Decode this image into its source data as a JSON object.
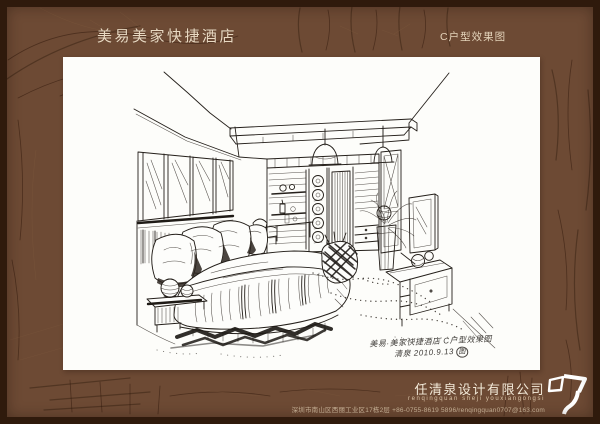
{
  "header": {
    "brand": "美易美家快捷酒店",
    "unit_label": "C户型效果图"
  },
  "artwork": {
    "type": "hand-drawn ink interior perspective sketch",
    "subject": "hotel guest room: double bed with pillows, framed headboard wall, ceiling light beam with pendant lamps, wardrobe display wall, plant, TV frame and desk",
    "caption_line1": "美易·美家快捷酒店 C户型效果图",
    "caption_line2": "清泉 2010.9.13",
    "caption_seal": "图"
  },
  "footer": {
    "company": "任清泉设计有限公司",
    "company_pinyin": "renqingquan sheji youxiangongsi",
    "contact": "深圳市南山区西丽工业区17栋2层 +86-0755-8619 5896/renqingquan0707@163.com",
    "logo": "renqingquan-monogram-logo"
  },
  "colors": {
    "board_brown": "#6d4a34",
    "border_dark": "#2f1a0c",
    "paper": "#fdfdfa",
    "ink": "#241f1a",
    "header_text": "#e9d9c2",
    "footer_text": "#f3ead9"
  }
}
